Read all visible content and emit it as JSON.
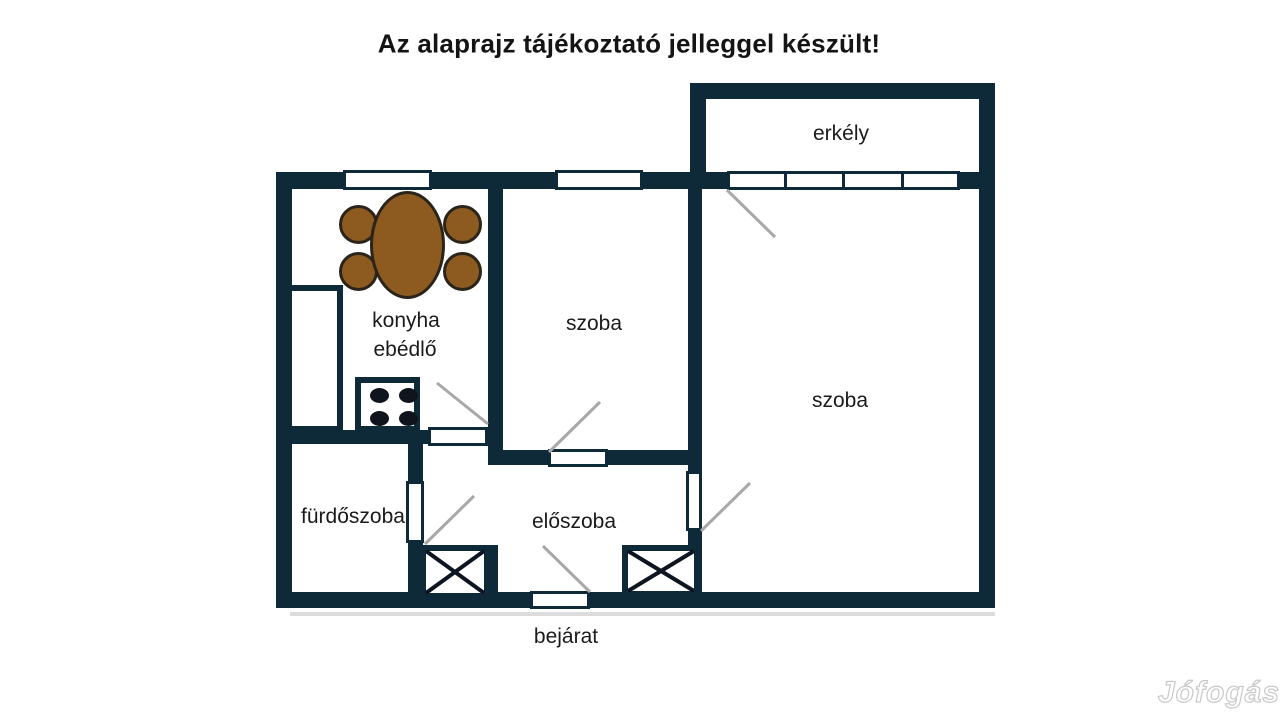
{
  "title": "Az alaprajz tájékoztató jelleggel készült!",
  "watermark": "Jófogás",
  "colors": {
    "wall": "#0e2a38",
    "table": "#8d5a20",
    "swing": "#a8a8a8",
    "floor": "#ffffff",
    "text": "#1b1b1b"
  },
  "rooms": {
    "balcony": {
      "label": "erkély"
    },
    "kitchen": {
      "label_line1": "konyha",
      "label_line2": "ebédlő"
    },
    "room_small": {
      "label": "szoba"
    },
    "room_large": {
      "label": "szoba"
    },
    "bathroom": {
      "label": "fürdőszoba"
    },
    "hallway": {
      "label": "előszoba"
    },
    "entrance": {
      "label": "bejárat"
    }
  }
}
